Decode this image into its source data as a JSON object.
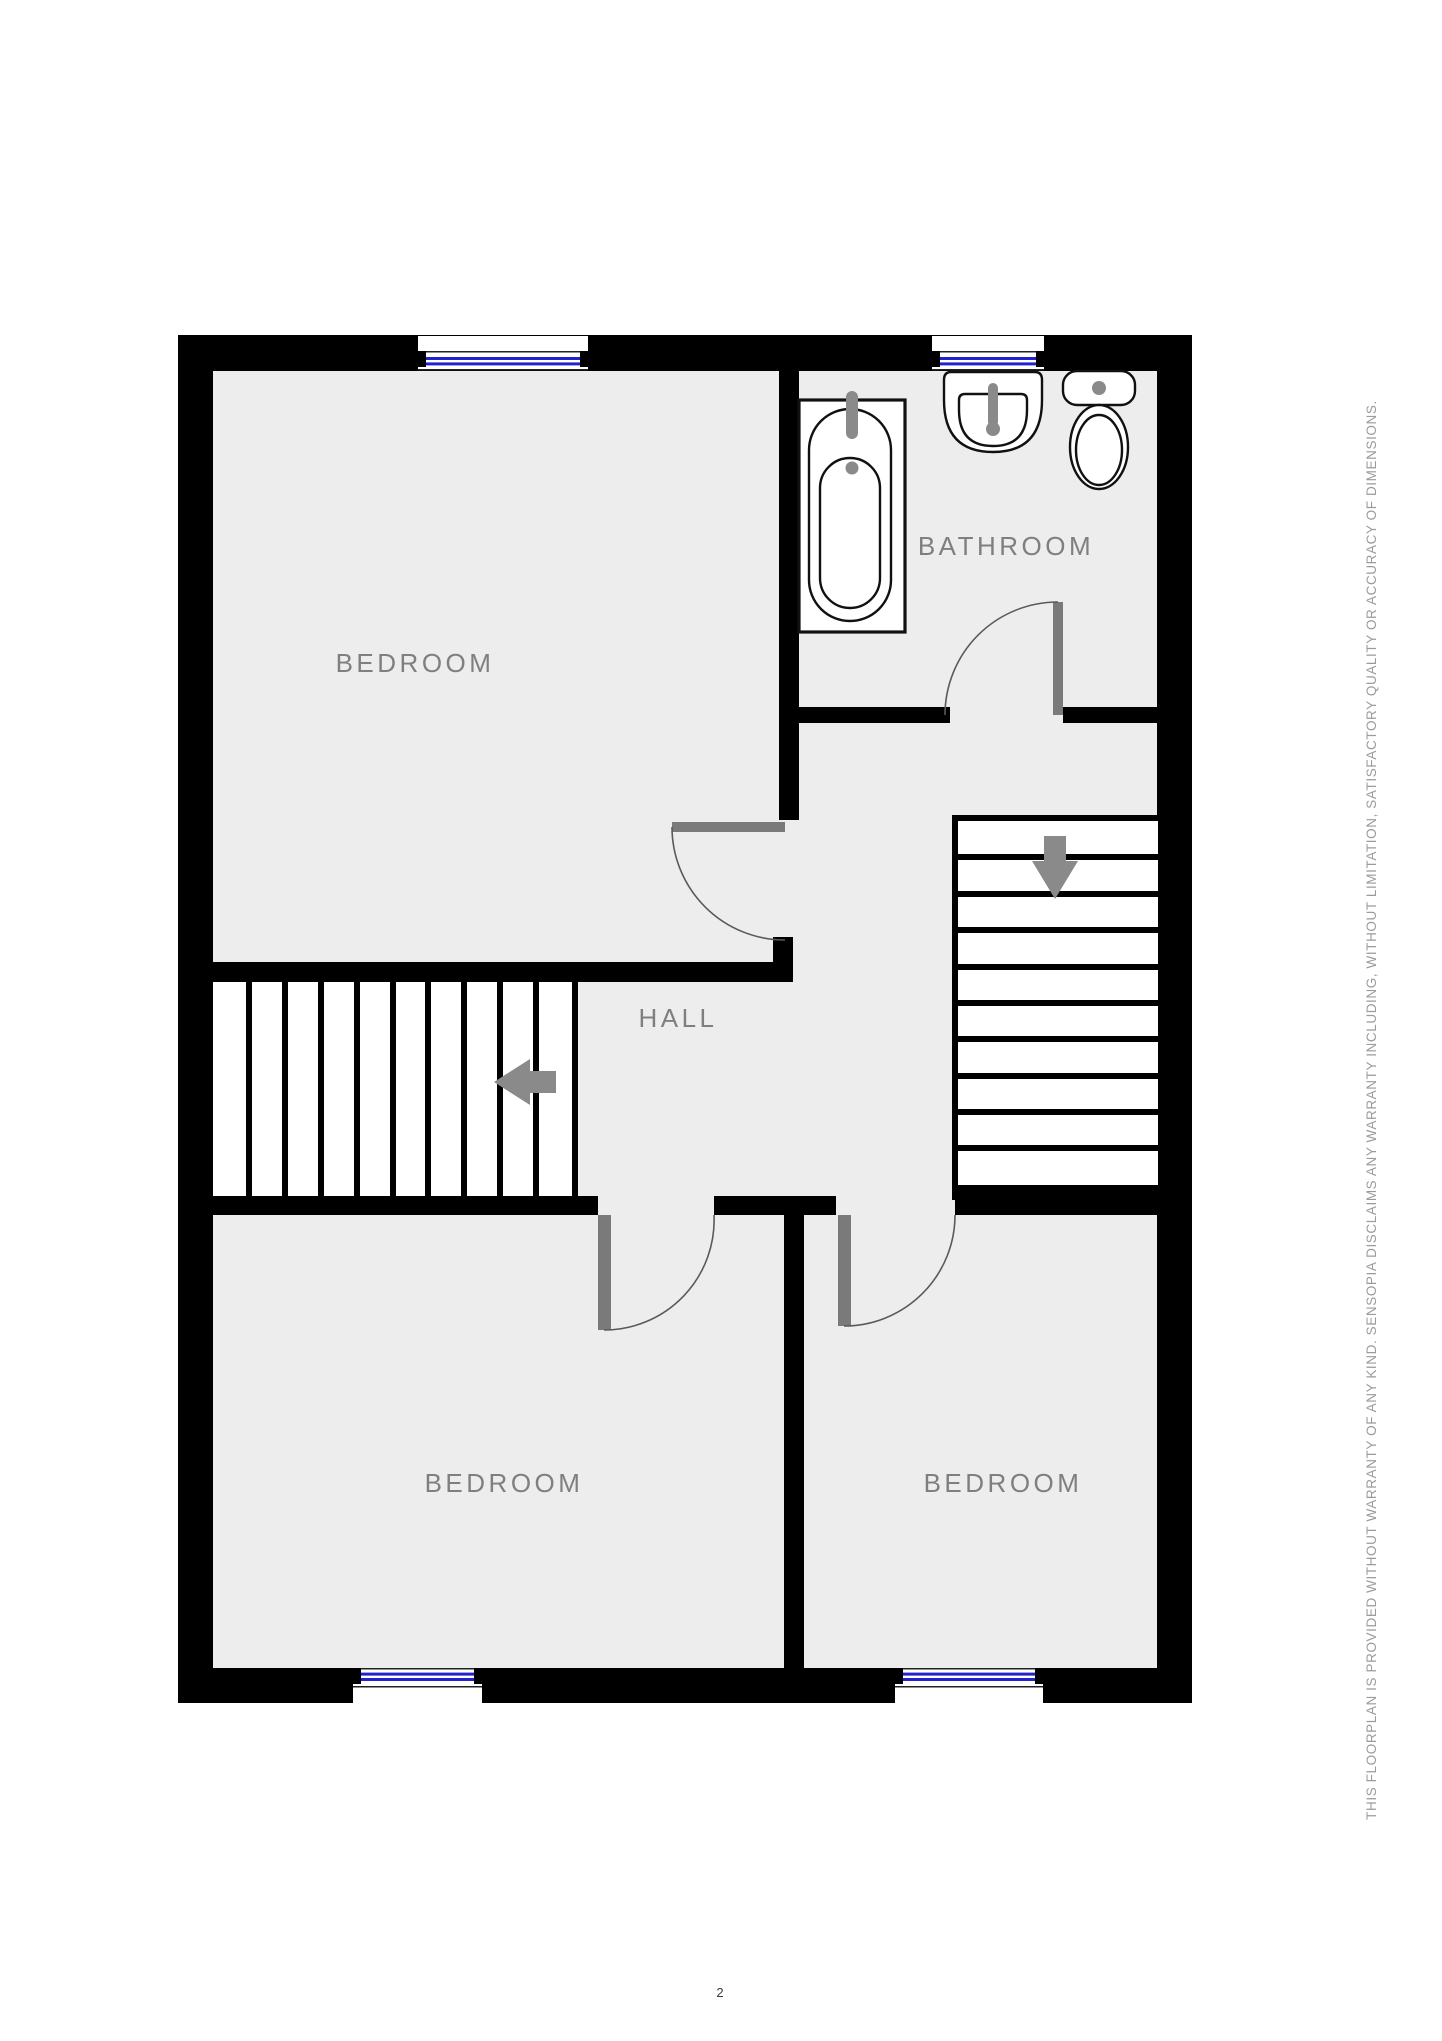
{
  "floorplan": {
    "rooms": {
      "bedroom_top": {
        "label": "BEDROOM"
      },
      "bathroom": {
        "label": "BATHROOM"
      },
      "hall": {
        "label": "HALL"
      },
      "bedroom_bottom_left": {
        "label": "BEDROOM"
      },
      "bedroom_bottom_right": {
        "label": "BEDROOM"
      }
    },
    "icons": {
      "bathtub": "bathtub-icon",
      "sink": "sink-icon",
      "toilet": "toilet-icon",
      "stairs_left_arrow": "arrow-left-icon",
      "stairs_down_arrow": "arrow-down-icon",
      "window_glazing": "window-icon"
    },
    "theme": {
      "wall_color": "#000000",
      "floor_color": "#ededee",
      "outside_color": "#ffffff",
      "window_color": "#2222cc",
      "door_color": "#7a7a7a",
      "arc_color": "#5a5a5a",
      "label_color": "#7f7f7f",
      "disclaimer_color": "#9b9b9b",
      "page_number_color": "#3a3a3a"
    }
  },
  "disclaimer": {
    "text": "THIS FLOORPLAN IS PROVIDED WITHOUT WARRANTY OF ANY KIND. SENSOPIA DISCLAIMS ANY WARRANTY INCLUDING, WITHOUT LIMITATION, SATISFACTORY QUALITY OR ACCURACY OF DIMENSIONS."
  },
  "footer": {
    "page_number": "2"
  }
}
